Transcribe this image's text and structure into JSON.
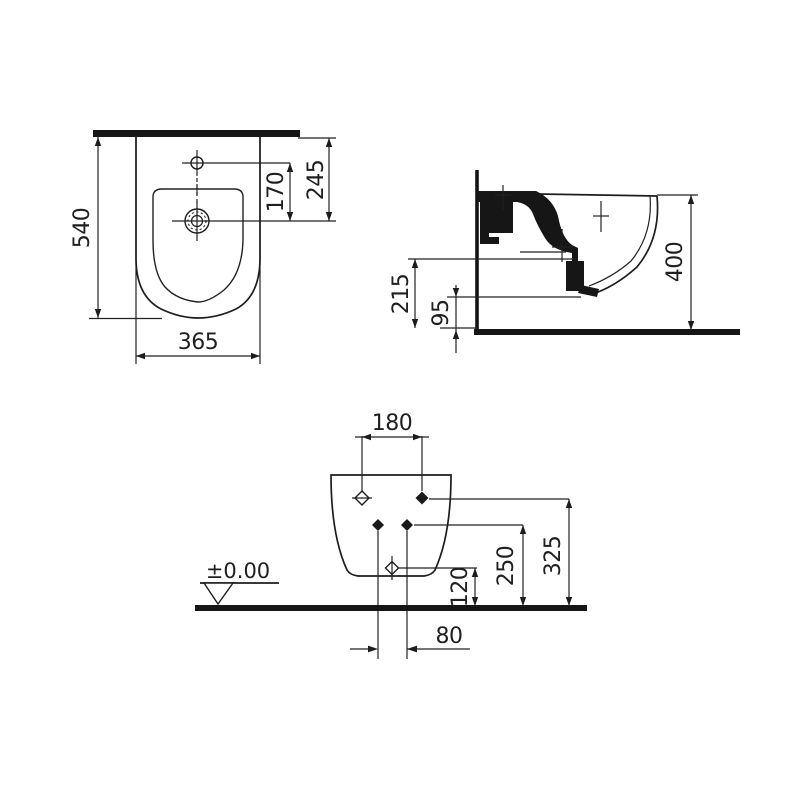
{
  "drawing": {
    "kind": "wall-hung bidet installation drawing",
    "views": {
      "plan": {
        "depth": "540",
        "width": "365",
        "tap_to_drain": "170",
        "wall_to_drain": "245"
      },
      "side": {
        "overall_height": "400",
        "bowl_bottom_height": "215",
        "outlet_height": "95"
      },
      "rear": {
        "upper_hole_spacing": "180",
        "upper_holes_height": "325",
        "lower_holes_height": "250",
        "outlet_height": "120",
        "lower_hole_spacing": "80",
        "floor_datum": "±0.00"
      }
    }
  }
}
